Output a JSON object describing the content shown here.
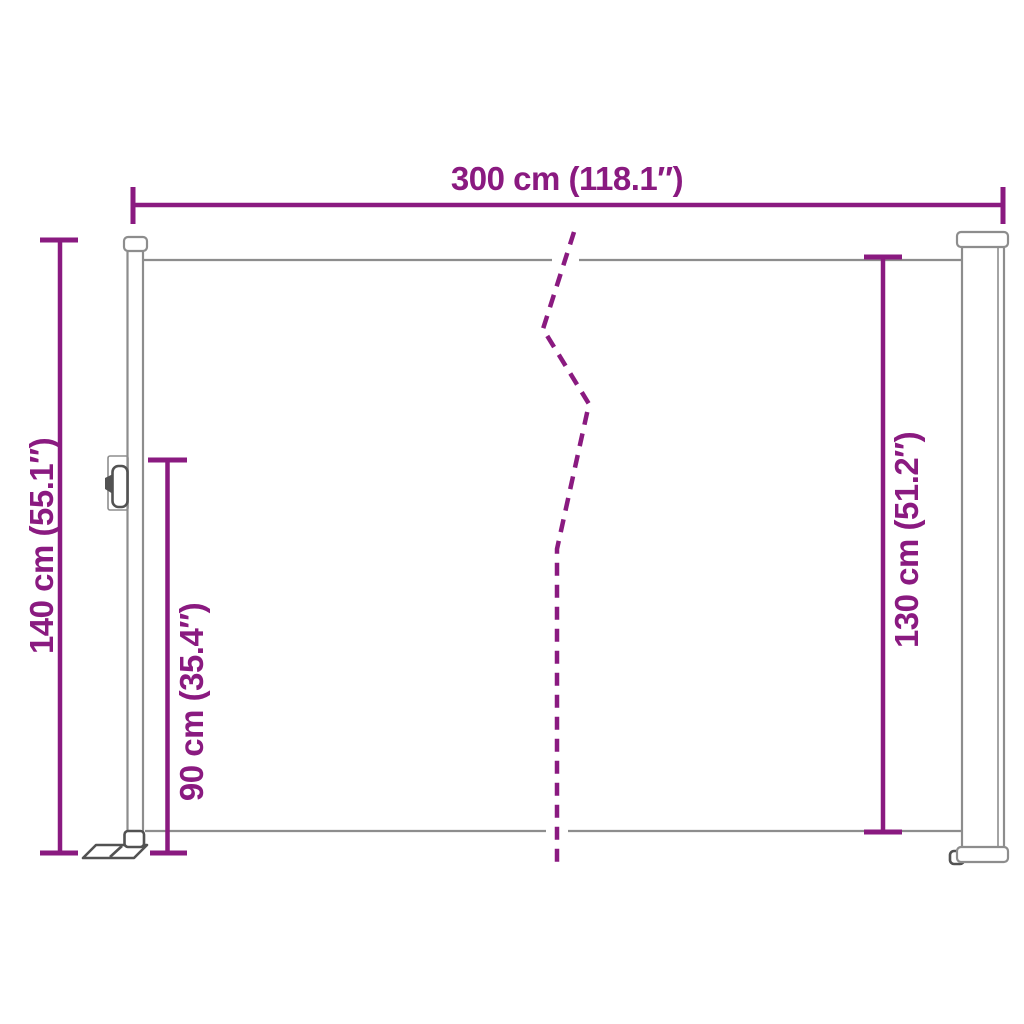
{
  "colors": {
    "dimension": "#8a1a80",
    "structure": "#8d8d8d",
    "structure_dark": "#525252",
    "background": "#ffffff"
  },
  "diagram": {
    "type": "product-dimension-drawing",
    "subject": "retractable side awning",
    "dimensions": {
      "width": {
        "cm": 300,
        "inches": 118.1,
        "label": "300 cm (118.1″)"
      },
      "height_total": {
        "cm": 140,
        "inches": 55.1,
        "label": "140 cm (55.1″)"
      },
      "height_handle": {
        "cm": 90,
        "inches": 35.4,
        "label": "90 cm (35.4″)"
      },
      "height_fabric": {
        "cm": 130,
        "inches": 51.2,
        "label": "130 cm (51.2″)"
      }
    }
  }
}
